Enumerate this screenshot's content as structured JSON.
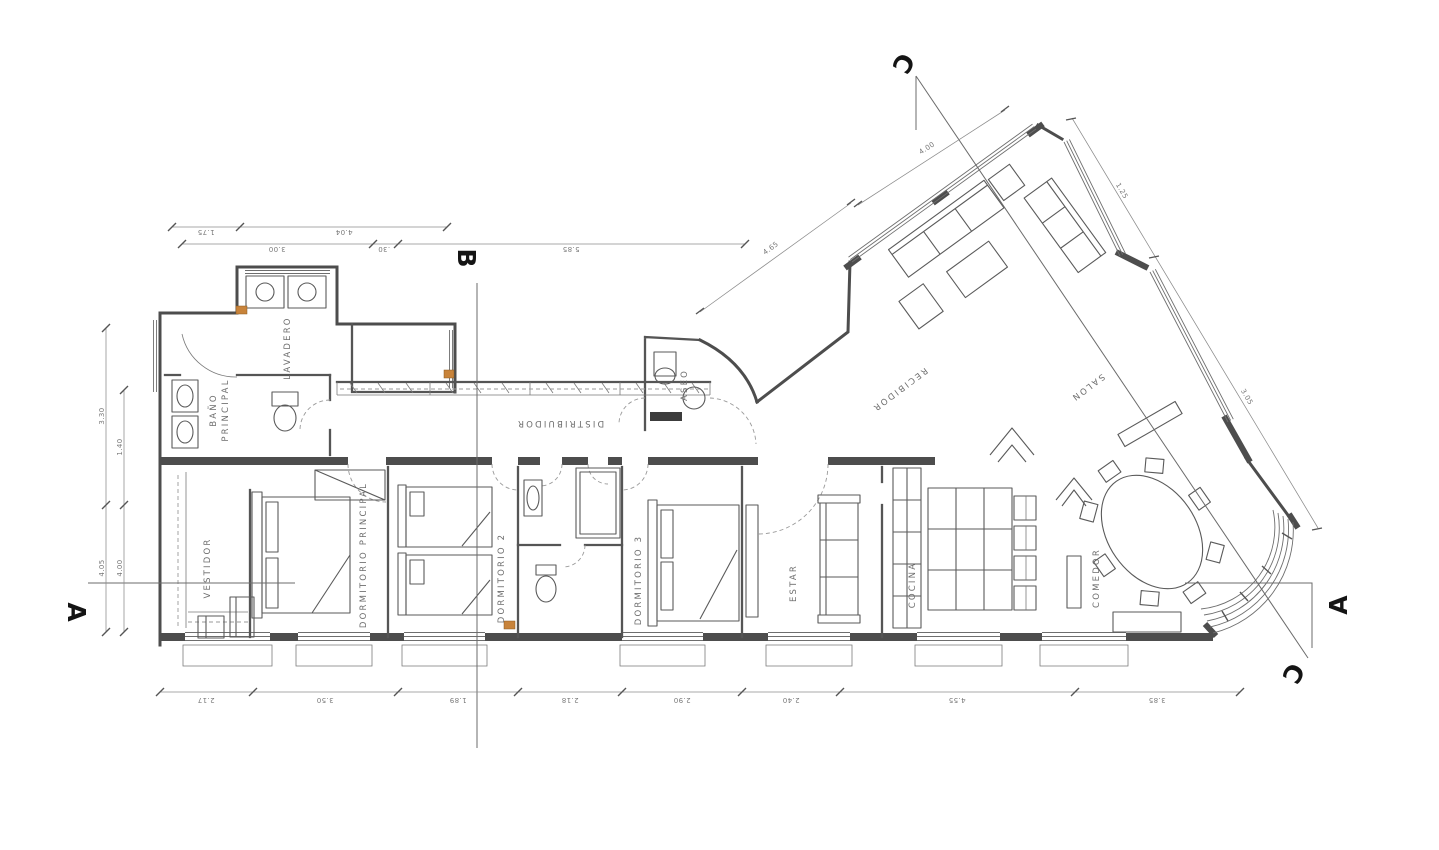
{
  "palette": {
    "background": "#ffffff",
    "line": "#4d4d4d",
    "text": "#6d6d6d",
    "accent": "#c8833a"
  },
  "rooms": {
    "vestidor": {
      "label": "VESTIDOR"
    },
    "dormitorio_principal": {
      "label": "DORMITORIO PRINCIPAL"
    },
    "bano_principal": {
      "line1": "BAÑO",
      "line2": "PRINCIPAL"
    },
    "lavadero": {
      "label": "LAVADERO"
    },
    "distribuidor": {
      "label": "DISTRIBUIDOR"
    },
    "dormitorio_2": {
      "label": "DORMITORIO 2"
    },
    "aseo": {
      "label": "ASEO"
    },
    "dormitorio_3": {
      "label": "DORMITORIO 3"
    },
    "estar": {
      "label": "ESTAR"
    },
    "recibidor": {
      "label": "RECIBIDOR"
    },
    "salon": {
      "label": "SALON"
    },
    "cocina": {
      "label": "COCINA"
    },
    "comedor": {
      "label": "COMEDOR"
    }
  },
  "section_markers": {
    "a_left": "A",
    "b_top": "B",
    "c_top": "C",
    "c_bottom": "C",
    "a_right": "A"
  },
  "dimensions": {
    "top_row_1": [
      "1.75",
      "4.04"
    ],
    "top_row_2": [
      "3.00",
      ".30",
      "5.85"
    ],
    "left_outer": [
      "3.30",
      "4.05"
    ],
    "left_inner": [
      "1.40",
      "4.00"
    ],
    "bottom": [
      "2.17",
      "3.50",
      "1.89",
      "2.18",
      "2.90",
      "2.40",
      "4.55",
      "3.85"
    ],
    "salon_nw": "4.00",
    "salon_sw": "4.65",
    "salon_ne_upper": "1.25",
    "salon_ne_lower": "3.05"
  }
}
